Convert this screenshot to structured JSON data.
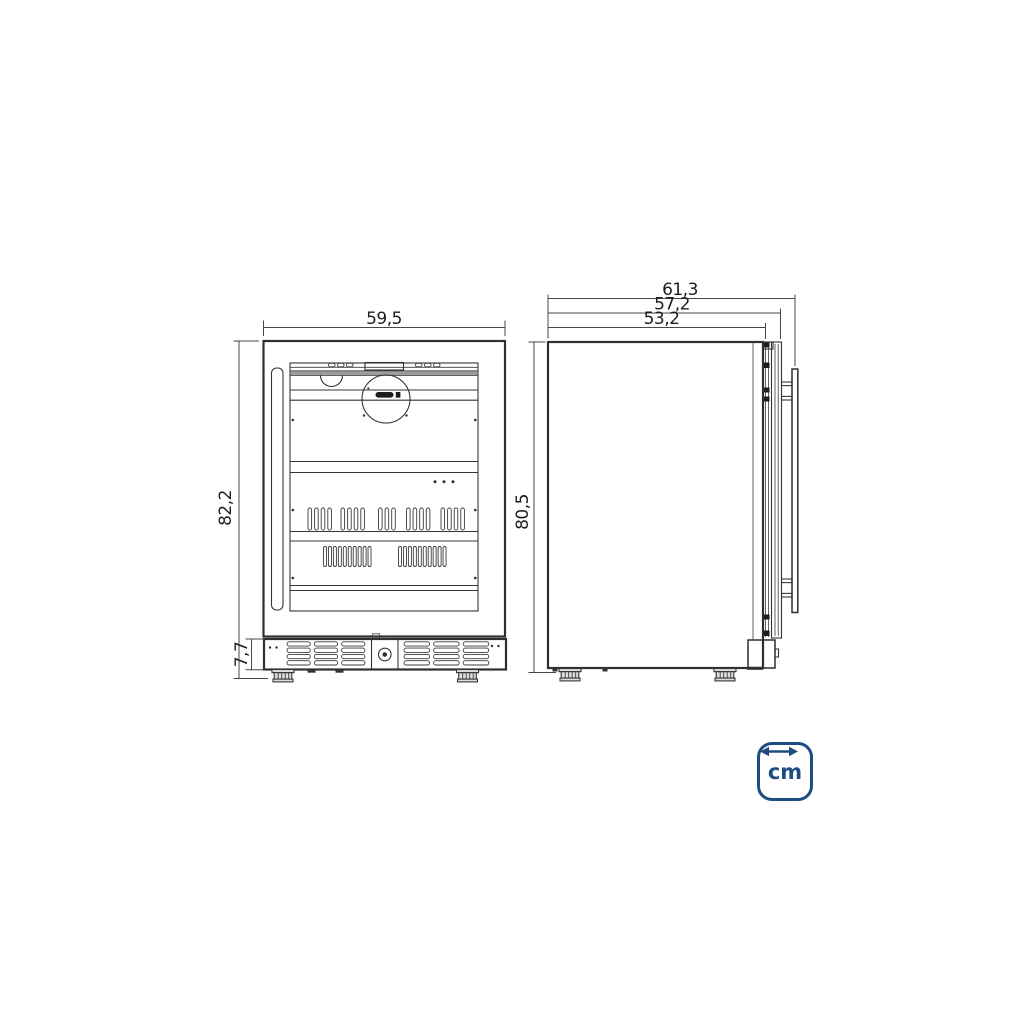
{
  "diagram": {
    "unit_badge": {
      "label": "cm",
      "color": "#1d4d80"
    },
    "front_view": {
      "width_cm": "59,5",
      "height_cm": "82,2",
      "base_height_cm": "7,7"
    },
    "side_view": {
      "depth_total_cm": "61,3",
      "depth_with_door_cm": "57,2",
      "depth_cabinet_cm": "53,2",
      "height_cm": "80,5"
    }
  }
}
